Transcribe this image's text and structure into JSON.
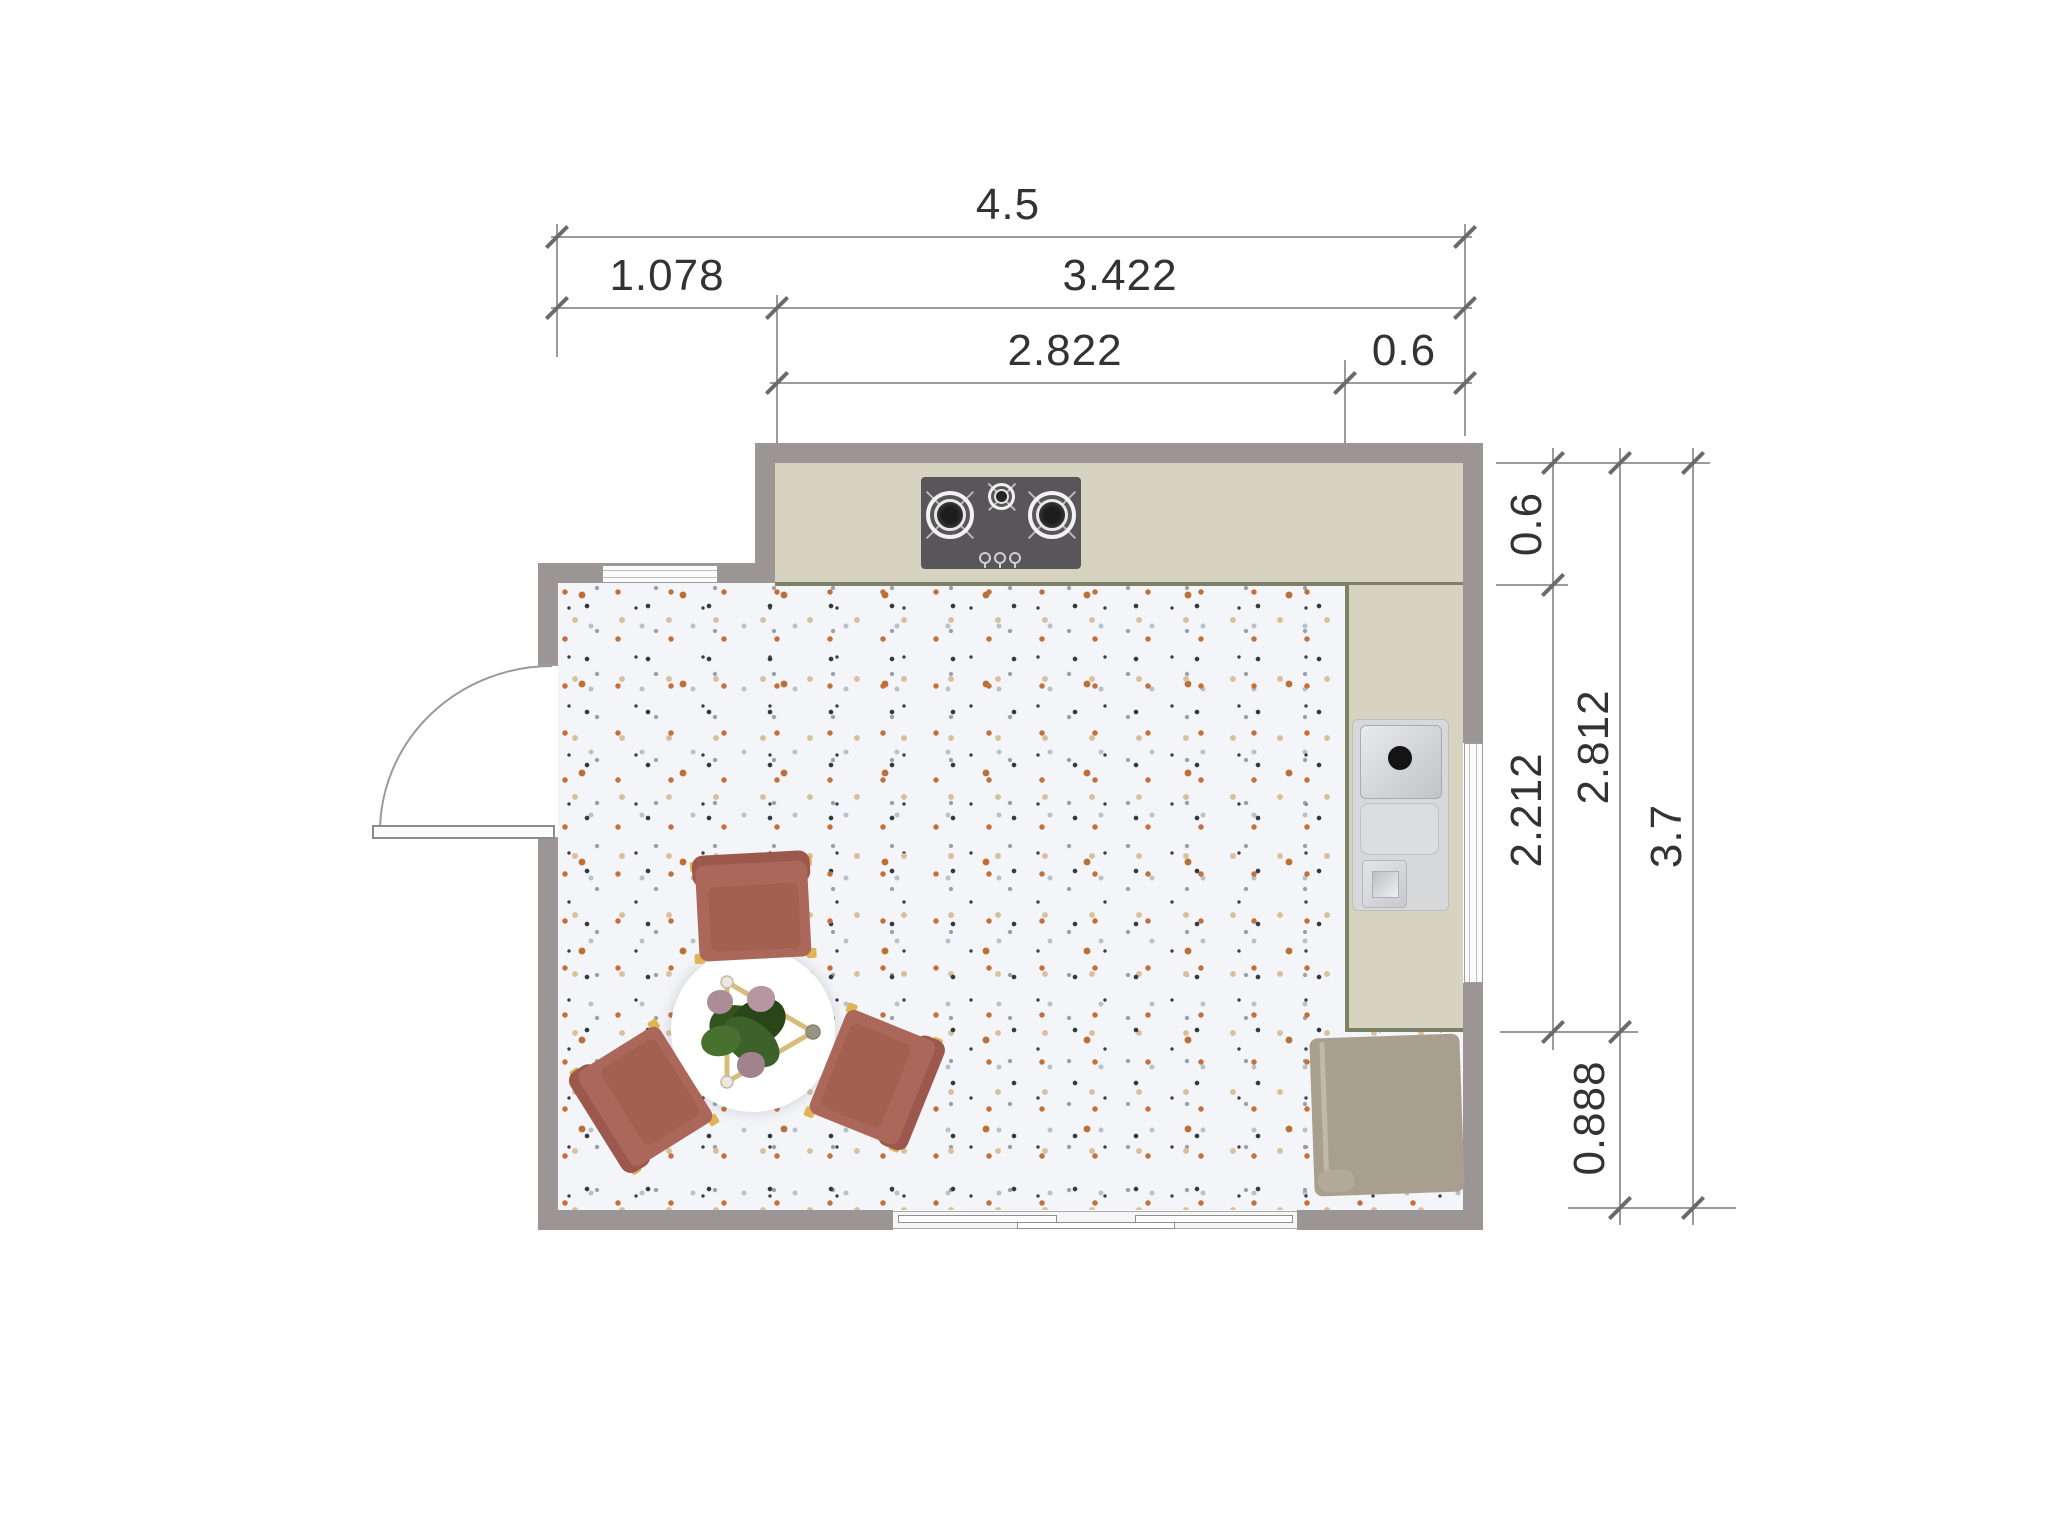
{
  "drawing": {
    "type": "kitchen-dining floor plan, top view",
    "unit_note": "",
    "colors": {
      "wall": "#9b9596",
      "counter": "#d6d4c0",
      "counter_edge": "#7d8166",
      "floor_base": "#f4f5f8",
      "floor_speckles": [
        "#c0713c",
        "#323a40",
        "#97a0ab",
        "#d9c09c"
      ],
      "chair": "#ac675b",
      "chair_back": "#9c584c",
      "chair_leg": "#e0b455",
      "table": "#ffffff",
      "table_frame": "#d8bc7c",
      "rug": "#a89f8e",
      "cooktop": "#59565a",
      "sink": "#d7d8da",
      "dimension_line": "#9b9b9b",
      "dimension_text": "#333333"
    }
  },
  "dimensions": {
    "top_rows": [
      {
        "name": "overall-width",
        "label": "4.5"
      },
      {
        "name": "left-section-width",
        "label": "1.078"
      },
      {
        "name": "upper-section-width",
        "label": "3.422"
      },
      {
        "name": "counter-run-width",
        "label": "2.822"
      },
      {
        "name": "right-counter-width",
        "label": "0.6"
      }
    ],
    "right_rows": [
      {
        "name": "top-counter-depth",
        "label": "0.6"
      },
      {
        "name": "side-counter-length",
        "label": "2.212"
      },
      {
        "name": "side-counter-total",
        "label": "2.812"
      },
      {
        "name": "below-counter-gap",
        "label": "0.888"
      },
      {
        "name": "overall-height",
        "label": "3.7"
      }
    ]
  },
  "fixtures": {
    "cooktop": "gas cooktop, 2 large burners, 1 small burner, 3 knobs",
    "sink": "sink unit with basin, drain board and half basin",
    "table": "round dining table with plant and triangular frame",
    "chairs": "3 terracotta armchairs",
    "rug": "tan mat at lower right",
    "door": "hinged door on left wall with swing arc",
    "window_top": "window in upper-left wall",
    "window_right": "window in right wall",
    "sliding_door": "sliding glass door in bottom wall"
  }
}
